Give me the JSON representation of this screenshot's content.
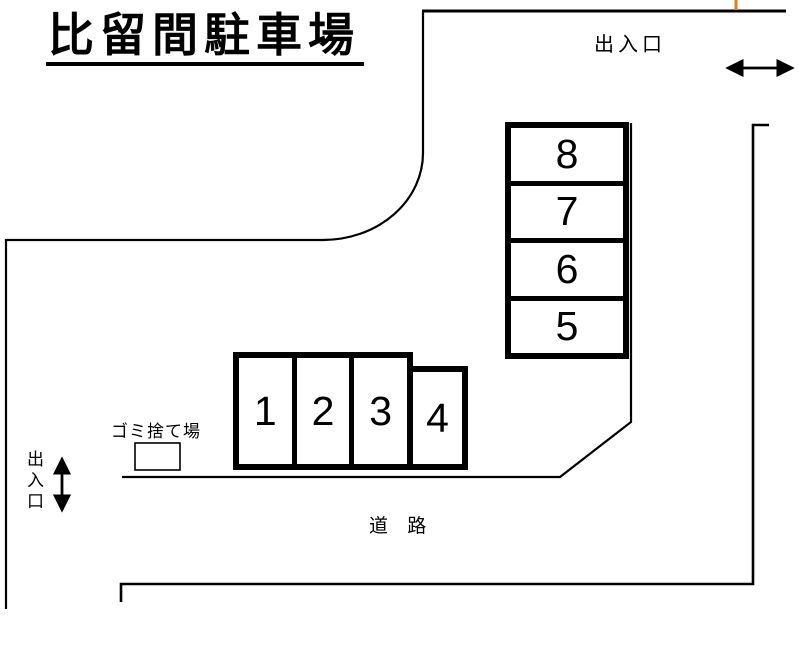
{
  "title": {
    "text": "比留間駐車場"
  },
  "labels": {
    "top_entrance": "出入口",
    "side_entrance": "出入口",
    "garbage_area": "ゴミ捨て場",
    "road": "道 路"
  },
  "parking": {
    "vertical_spaces": [
      "8",
      "7",
      "6",
      "5"
    ],
    "horizontal_spaces": [
      "1",
      "2",
      "3",
      "4"
    ]
  },
  "colors": {
    "line": "#000000",
    "background": "#ffffff",
    "cursor_mark": "#e07f1c"
  }
}
